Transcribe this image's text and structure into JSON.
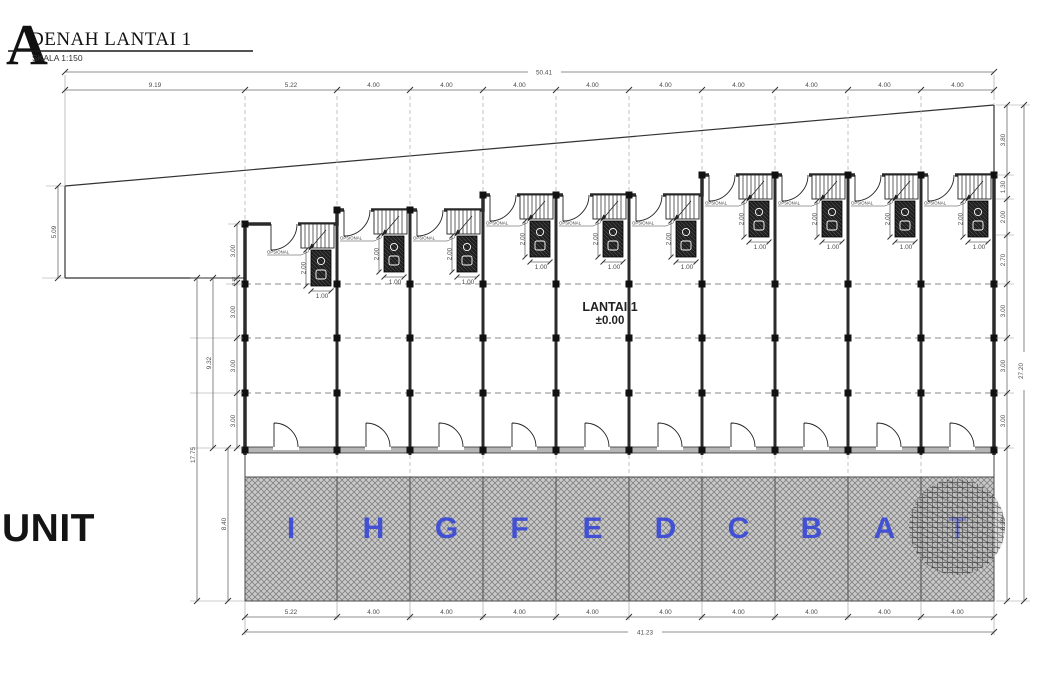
{
  "header": {
    "logo_letter": "A",
    "title": "DENAH LANTAI 1",
    "scale": "SKALA  1:150"
  },
  "labels": {
    "unit_side": "UNIT",
    "floor_line1": "LANTAI  1",
    "floor_line2": "±0.00"
  },
  "units": {
    "letters": [
      "I",
      "H",
      "G",
      "F",
      "E",
      "D",
      "C",
      "B",
      "A",
      "T"
    ]
  },
  "motif": {
    "bath_height": "2.00",
    "bath_width": "1.00",
    "optional": "OPSIONAL"
  },
  "dims": {
    "top": {
      "overall": "50.41",
      "segments": [
        "9.19",
        "5.22",
        "4.00",
        "4.00",
        "4.00",
        "4.00",
        "4.00",
        "4.00",
        "4.00",
        "4.00",
        "4.00"
      ]
    },
    "bottom": {
      "overall": "41.23",
      "segments": [
        "5.22",
        "4.00",
        "4.00",
        "4.00",
        "4.00",
        "4.00",
        "4.00",
        "4.00",
        "4.00",
        "4.00"
      ]
    },
    "left": {
      "front_offset": "5.09",
      "total": "17.75",
      "upper": "9.32",
      "band": "8.40",
      "chain": [
        "3.00",
        "0.32",
        "3.00",
        "3.00",
        "3.00"
      ]
    },
    "right": {
      "total": "27.20",
      "chain": [
        "3.80",
        "1.30",
        "2.00",
        "2.70",
        "3.00",
        "3.00",
        "3.00",
        "8.39"
      ]
    }
  },
  "colors": {
    "unit_letter_blue": "#4250d4",
    "wall_dark": "#2b2b2b",
    "hatch_gray": "#c9c9c9",
    "dim_gray": "#4a4a4a"
  }
}
